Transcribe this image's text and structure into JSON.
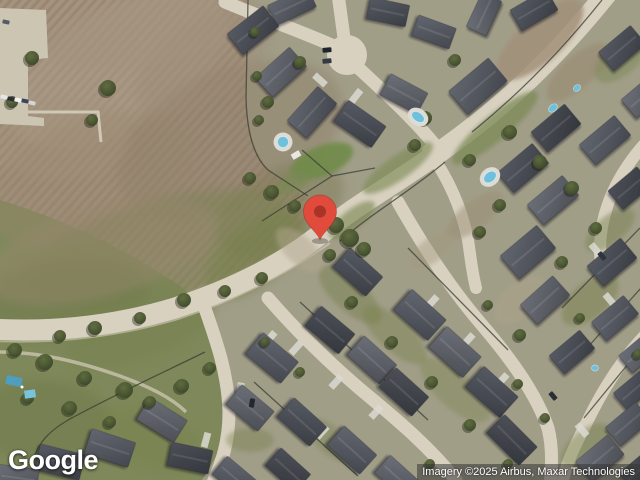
{
  "map": {
    "logo_text": "Google",
    "attribution": "Imagery ©2025 Airbus, Maxar Technologies",
    "marker": {
      "name": "map-pin",
      "color": "#E04B3C",
      "dot_color": "#A93324",
      "x": 320,
      "y": 240
    }
  }
}
